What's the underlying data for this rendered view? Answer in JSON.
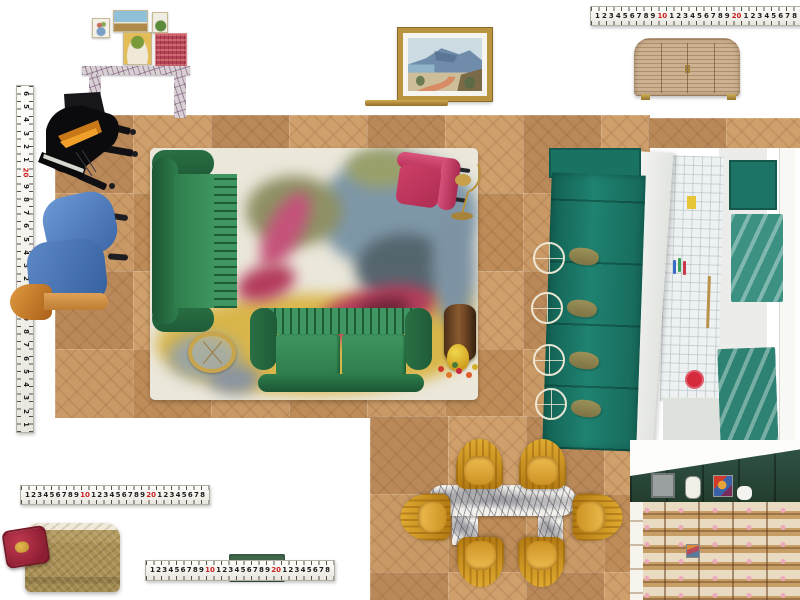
{
  "canvas": {
    "width": 800,
    "height": 600,
    "background": "#ffffff"
  },
  "rulers": {
    "style": "measuring-tape",
    "tick_color": "#55524a",
    "number_color": "#1c1c1c",
    "decade_color": "#cc2020",
    "horizontal_numbers": [
      "1",
      "2",
      "3",
      "4",
      "5",
      "6",
      "7",
      "8",
      "9",
      {
        "n": "10",
        "red": true
      },
      "1",
      "2",
      "3",
      "4",
      "5",
      "6",
      "7",
      "8",
      "9",
      {
        "n": "20",
        "red": true
      },
      "1",
      "2",
      "3",
      "4",
      "5",
      "6",
      "7",
      "8"
    ],
    "vertical_numbers": [
      "6",
      "5",
      "4",
      "3",
      "2",
      "1",
      {
        "n": "20",
        "red": true
      },
      "9",
      "8",
      "7",
      "6",
      "5",
      "4",
      "3",
      "2",
      "1",
      {
        "n": "10",
        "red": true
      },
      "9",
      "8",
      "7",
      "6",
      "5",
      "4",
      "3",
      "2",
      "1"
    ]
  },
  "colors": {
    "floor_wood": "#c59464",
    "sofa_green": "#2e7d4c",
    "armchair_pink": "#c23b62",
    "armchair_blue": "#4d7fc4",
    "dining_chair_gold": "#cf9526",
    "kitchen_teal": "#1f8271",
    "pantry_green": "#2b4a3a",
    "rug_cream": "#ebe7da",
    "rug_mustard": "#d9b64a",
    "brass": "#c8a44c",
    "marble_console": "#d9d0d6",
    "ruler_red": "#cc2020"
  },
  "items": {
    "floor": {
      "label": "Oak parquet floor plan"
    },
    "gallery_wall": {
      "label": "Gallery wall of five art prints",
      "count": 5
    },
    "console_table": {
      "label": "Purple-veined marble console"
    },
    "painting": {
      "label": "Framed coastal landscape painting"
    },
    "brass_rail": {
      "label": "Brass rail"
    },
    "credenza": {
      "label": "Reeded rattan credenza with brass feet"
    },
    "grand_piano": {
      "label": "Black grand piano"
    },
    "armchair_blue": {
      "label": "Blue upholstered armchair"
    },
    "stool_wood": {
      "label": "Turned timber stool"
    },
    "rug": {
      "label": "Abstract floral rug"
    },
    "sofa_left": {
      "label": "Green velvet sofa (vertical)"
    },
    "sofa_bottom": {
      "label": "Green velvet sofa (horizontal)"
    },
    "armchair_pink": {
      "label": "Magenta velvet armchair"
    },
    "floor_lamp": {
      "label": "Brass arc floor lamp"
    },
    "tray_table": {
      "label": "Brass tray side table"
    },
    "drum_table": {
      "label": "Timber drum side table"
    },
    "table_lamp": {
      "label": "Yellow mushroom lamp with flowers"
    },
    "kitchen_photo": {
      "label": "Teal kitchen photo with island, marble worktop, zellige tiles",
      "stool_count": 4
    },
    "dining_table": {
      "label": "Veined marble dining table"
    },
    "dining_chairs": {
      "label": "Mustard velvet tub chairs",
      "count": 6
    },
    "ottoman": {
      "label": "Brushed brass ottoman"
    },
    "pillow": {
      "label": "Red velvet cushion with gold crest"
    },
    "green_strip": {
      "label": "Small green object behind ruler"
    },
    "pantry_photo": {
      "label": "Green kitchen pantry photo with timber shelving"
    }
  }
}
